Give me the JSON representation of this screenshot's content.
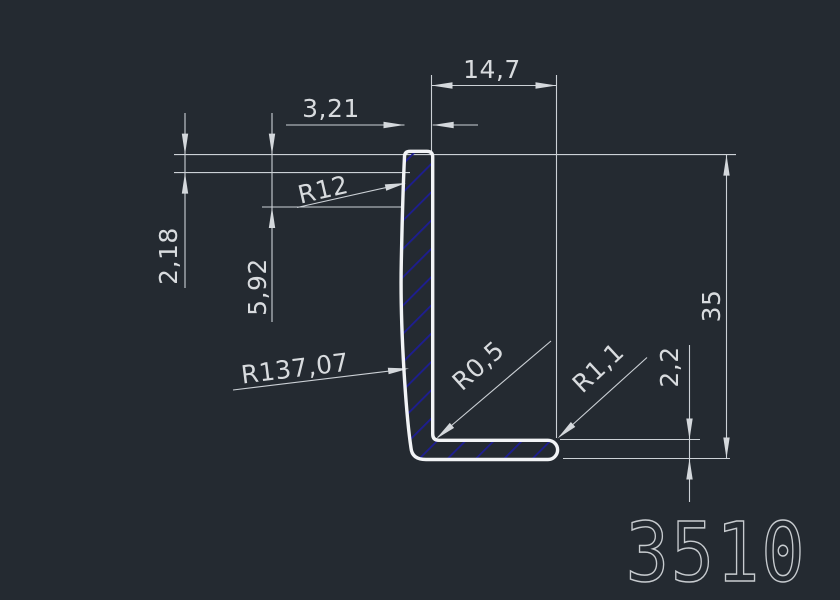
{
  "drawing": {
    "type": "cad-profile-cross-section",
    "part_number": "3510",
    "dimensions": {
      "leg_length_top": "14,7",
      "top_thickness": "3,21",
      "radius_top_outer": "R12",
      "vertical_offset_small": "2,18",
      "vertical_offset_large": "5,92",
      "radius_back_face": "R137,07",
      "radius_inner_corner": "R0,5",
      "radius_end_cap": "R1,1",
      "base_thickness": "2,2",
      "total_height": "35"
    },
    "colors": {
      "background": "#242a31",
      "dimension_lines": "#ccd1d6",
      "dimension_text": "#d8dbde",
      "profile_outline": "#f2f4f6",
      "hatch_fill": "#1d1d92",
      "part_number": "#c7cbcf"
    }
  }
}
